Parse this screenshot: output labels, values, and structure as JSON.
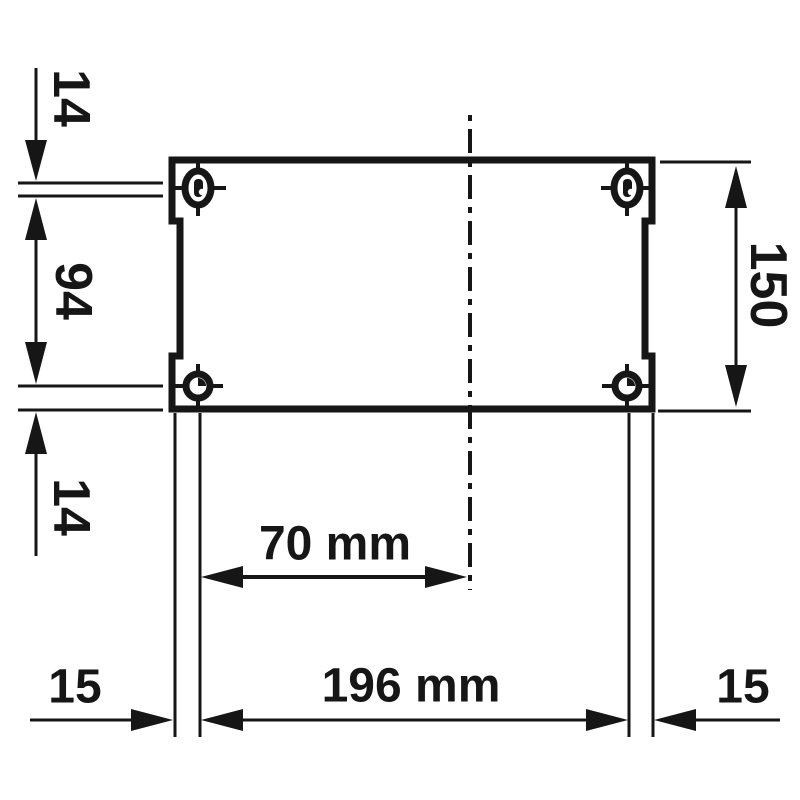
{
  "drawing": {
    "type": "technical-dimension-drawing",
    "subject": "enclosure mounting hole pattern, front view",
    "unit": "mm",
    "colors": {
      "line": "#161616",
      "background": "#ffffff"
    },
    "dimensions": {
      "top_hole_offset": {
        "label": "14",
        "value": 14,
        "orientation": "vertical-left"
      },
      "hole_vertical_spacing": {
        "label": "94",
        "value": 94,
        "orientation": "vertical-left"
      },
      "bottom_hole_offset": {
        "label": "14",
        "value": 14,
        "orientation": "vertical-left"
      },
      "body_height": {
        "label": "150",
        "value": 150,
        "orientation": "vertical-right"
      },
      "center_to_hole": {
        "label": "70 mm",
        "value": 70,
        "orientation": "horizontal"
      },
      "hole_horizontal_spacing": {
        "label": "196 mm",
        "value": 196,
        "orientation": "horizontal"
      },
      "left_margin": {
        "label": "15",
        "value": 15,
        "orientation": "horizontal"
      },
      "right_margin": {
        "label": "15",
        "value": 15,
        "orientation": "horizontal"
      }
    },
    "features": {
      "top_holes": "slotted mounting holes with center ticks",
      "bottom_holes": "round mounting holes with center ticks",
      "centerline": "vertical dash-dot axis"
    }
  }
}
